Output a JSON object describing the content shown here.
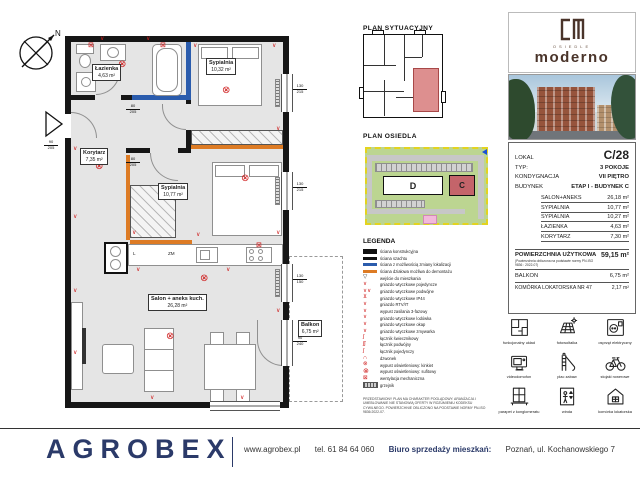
{
  "brand": {
    "estate": "OSIEDLE",
    "name": "moderno",
    "footer_logo": "AGROBEX"
  },
  "compass": {
    "north": "N"
  },
  "plan": {
    "rooms": {
      "bathroom": {
        "name": "Łazienka",
        "area": "4,63 m²"
      },
      "bedroom1": {
        "name": "Sypialnia",
        "area": "10,32 m²"
      },
      "corridor": {
        "name": "Korytarz",
        "area": "7,35 m²"
      },
      "bedroom2": {
        "name": "Sypialnia",
        "area": "10,77 m²"
      },
      "living": {
        "name": "Salon + aneks kuch.",
        "area": "26,28 m²"
      },
      "balcony": {
        "name": "Balkon",
        "area": "6,75 m²"
      }
    },
    "dims": {
      "door_bathroom": {
        "w": "80",
        "h": "205"
      },
      "door_bedroom": {
        "w": "80",
        "h": "205"
      },
      "door_entry": {
        "w": "90",
        "h": "205"
      },
      "win_bedroom1": {
        "w": "130",
        "h": "215"
      },
      "win_bedroom2": {
        "w": "130",
        "h": "215"
      },
      "win_living": {
        "w": "130",
        "h": "150"
      },
      "door_balcony": {
        "w": "90",
        "h": "240"
      }
    },
    "kitchen": {
      "dishwasher": "ZM",
      "fridge": "L"
    }
  },
  "site_plan": {
    "title": "PLAN SYTUACYJNY"
  },
  "estate_plan": {
    "title": "PLAN OSIEDLA",
    "building_d": "D",
    "building_c": "C"
  },
  "legend": {
    "title": "LEGENDA",
    "items": [
      {
        "label": "ściana konstrukcyjna"
      },
      {
        "label": "ściana szachtu"
      },
      {
        "label": "ściana z możliwością zmiany lokalizacji"
      },
      {
        "label": "ściana działowa możliwa do demontażu"
      },
      {
        "label": "wejście do mieszkania"
      },
      {
        "label": "gniazdo wtyczkowe pojedyncze"
      },
      {
        "label": "gniazdo wtyczkowe podwójne"
      },
      {
        "label": "gniazdo wtyczkowe IP44"
      },
      {
        "label": "gniazdo RTV/IT"
      },
      {
        "label": "wypust zasilania 3-fazowy"
      },
      {
        "label": "gniazdo wtyczkowe lodówka"
      },
      {
        "label": "gniazdo wtyczkowe okap"
      },
      {
        "label": "gniazdo wtyczkowe zmywarka"
      },
      {
        "label": "łącznik świecznikowy"
      },
      {
        "label": "łącznik podwójny"
      },
      {
        "label": "łącznik pojedynczy"
      },
      {
        "label": "dzwonek"
      },
      {
        "label": "wypust oświetleniowy: kinkiet"
      },
      {
        "label": "wypust oświetleniowy: sufitowy"
      },
      {
        "label": "wentylacja mechaniczna"
      },
      {
        "label": "grzejnik"
      }
    ]
  },
  "disclaimer": "PRZEDSTAWIONY PLAN MA CHARAKTER POGLĄDOWY. ARANŻACJA I UMEBLOWANIE NIE STANOWIĄ OFERTY W ROZUMIENIU KODEKSU CYWILNEGO. POWIERZCHNIE OBLICZONO NA PODSTAWIE NORMY PN-ISO 9836:2022-07.",
  "unit_card": {
    "rows": [
      {
        "label": "LOKAL",
        "value": "C/28"
      },
      {
        "label": "TYP:",
        "value": "3 POKOJE"
      },
      {
        "label": "KONDYGNACJA",
        "value": "VII PIĘTRO"
      },
      {
        "label": "BUDYNEK",
        "value": "ETAP I - BUDYNEK C"
      }
    ],
    "areas": [
      {
        "name": "SALON+ANEKS",
        "value": "26,18 m²"
      },
      {
        "name": "SYPIALNIA",
        "value": "10,77 m²"
      },
      {
        "name": "SYPIALNIA",
        "value": "10,27 m²"
      },
      {
        "name": "ŁAZIENKA",
        "value": "4,63 m²"
      },
      {
        "name": "KORYTARZ",
        "value": "7,30 m²"
      }
    ],
    "usable": {
      "label": "POWIERZCHNIA UŻYTKOWA",
      "note": "(Powierzchnia obliczona na podstawie normy PN-ISO 9836 : 2022-07)",
      "value": "59,15 m²"
    },
    "balcony": {
      "label": "BALKON",
      "value": "6,75 m²"
    },
    "storage": {
      "label": "KOMÓRKA LOKATORSKA  NR 47",
      "value": "2,17 m²"
    }
  },
  "features": [
    {
      "label": "funkcjonalny układ"
    },
    {
      "label": "fotowoltaika"
    },
    {
      "label": "osprzęt elektryczny"
    },
    {
      "label": "videodomofon"
    },
    {
      "label": "plac zabaw"
    },
    {
      "label": "stojaki rowerowe"
    },
    {
      "label": "parapet z konglomeratu"
    },
    {
      "label": "winda"
    },
    {
      "label": "komórka lokatorska"
    }
  ],
  "footer": {
    "website": "www.agrobex.pl",
    "phone": "tel. 61 84 64 060",
    "office_label": "Biuro sprzedaży mieszkań:",
    "office_address": "Poznań, ul. Kochanowskiego 7"
  }
}
